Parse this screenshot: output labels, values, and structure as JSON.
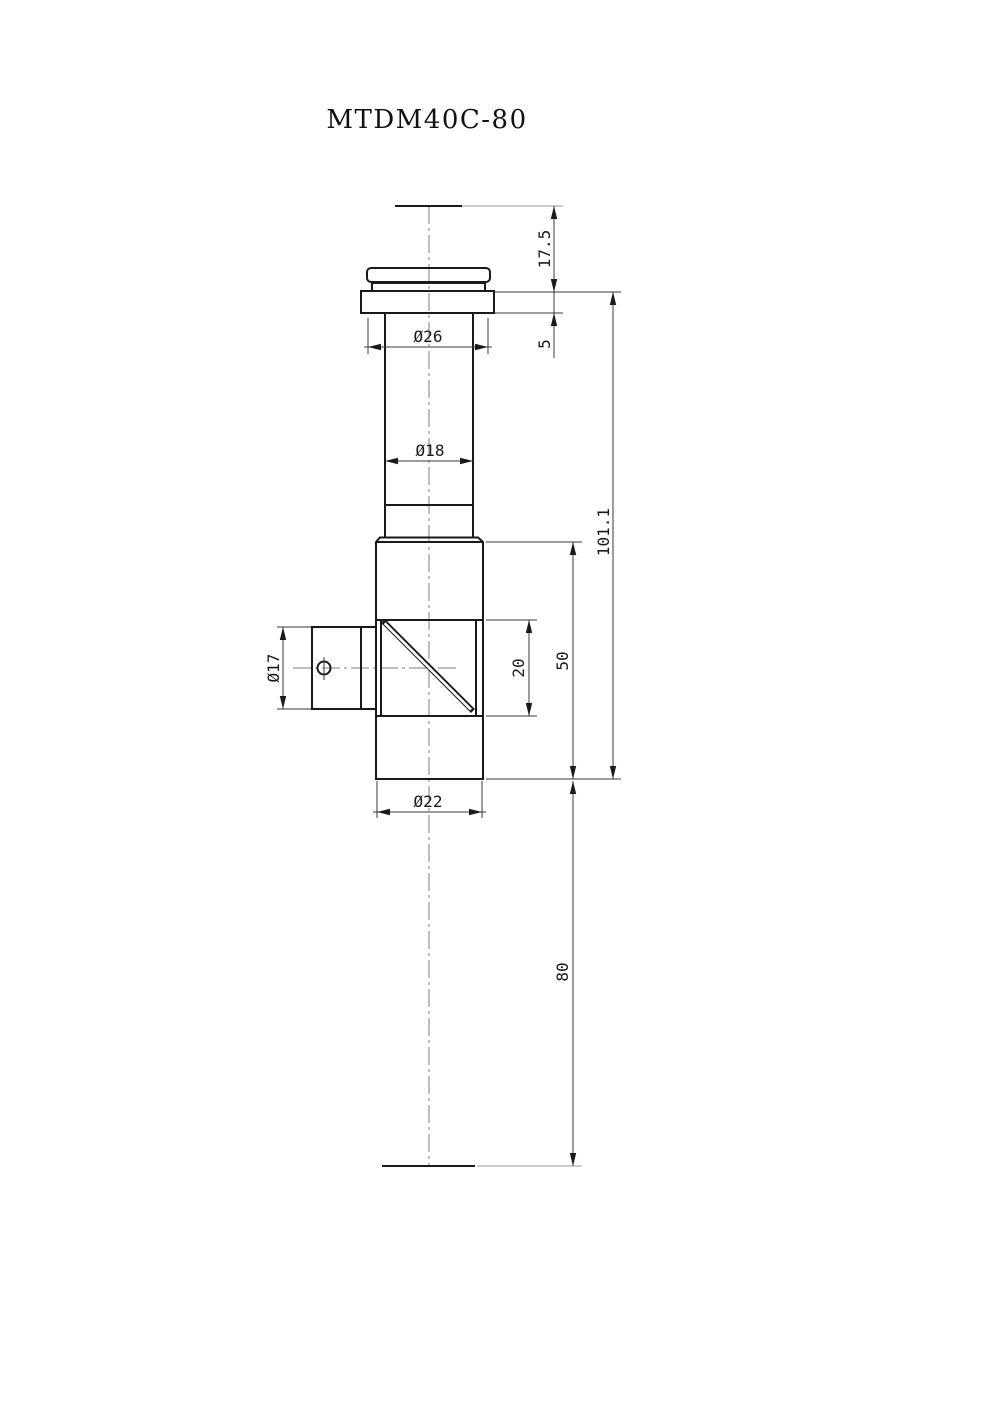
{
  "title": "MTDM40C-80",
  "dims": {
    "top_section_height": "17.5",
    "flange_thickness": "5",
    "cap_diameter": "Ø26",
    "tube_diameter": "Ø18",
    "side_port_diameter": "Ø17",
    "window_height": "20",
    "body_height": "50",
    "overall_length": "101.1",
    "body_diameter": "Ø22",
    "bottom_distance": "80"
  },
  "colors": {
    "outline": "#1a1a1a",
    "dimension_lines": "#3a3a3a",
    "centerline": "#7d7d7d",
    "background": "#ffffff"
  }
}
